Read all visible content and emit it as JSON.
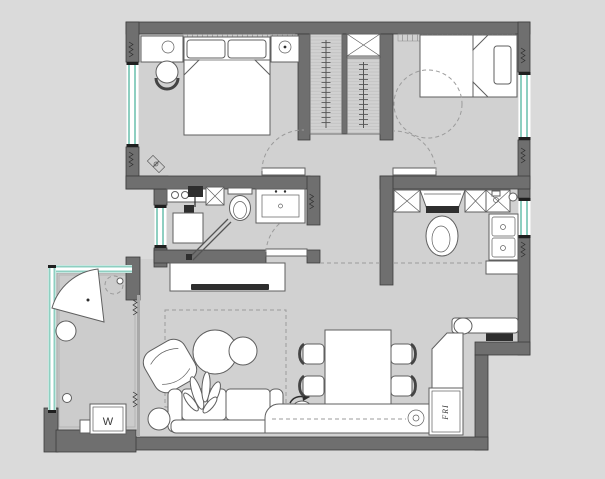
{
  "colors": {
    "background": "#dadada",
    "floor": "#d1d1d1",
    "balcony_floor": "#cccccc",
    "wall": "#6f6f6f",
    "wall_outline": "#3d3d3d",
    "glass": "#8ecfc1",
    "furniture_fill": "#ffffff",
    "furniture_outline": "#5f5f5f",
    "dashed": "#9b9b9b",
    "dark_detail": "#2e2e2e"
  },
  "text": {
    "washer_label": "W",
    "fridge_label": "FRI"
  },
  "plan": {
    "rooms": [
      {
        "id": "bedroom-left",
        "furniture": [
          "double-bed",
          "pillows",
          "nightstand-left",
          "nightstand-right",
          "table-lamps",
          "round-stool",
          "curtain-rail",
          "decor-symbol"
        ]
      },
      {
        "id": "bedroom-right",
        "furniture": [
          "double-bed",
          "pillow",
          "ceiling-light-zone",
          "curtain-rail"
        ]
      },
      {
        "id": "closet-block",
        "furniture": [
          "wardrobe-left",
          "wardrobe-right",
          "duct-shaft"
        ]
      },
      {
        "id": "bathroom",
        "furniture": [
          "shower-counter",
          "hand-shower",
          "shower-tray",
          "shower-screen",
          "duct-shaft",
          "toilet",
          "vanity-basin"
        ]
      },
      {
        "id": "kitchen",
        "furniture": [
          "base-cabinets",
          "range-hood",
          "cooktop",
          "pot",
          "double-sink",
          "low-cabinet"
        ]
      },
      {
        "id": "living-dining",
        "furniture": [
          "tv-cabinet",
          "tv",
          "rug",
          "armchair",
          "coffee-table-large",
          "coffee-table-small",
          "sofa",
          "plant",
          "side-table",
          "swivel-stool",
          "dining-table",
          "dining-chairs",
          "shoe-bench",
          "entry-console",
          "entry-door",
          "fridge"
        ]
      },
      {
        "id": "balcony",
        "furniture": [
          "fan-lounge-chair",
          "pouf",
          "ceiling-light",
          "washing-machine",
          "storage-box"
        ]
      }
    ]
  }
}
